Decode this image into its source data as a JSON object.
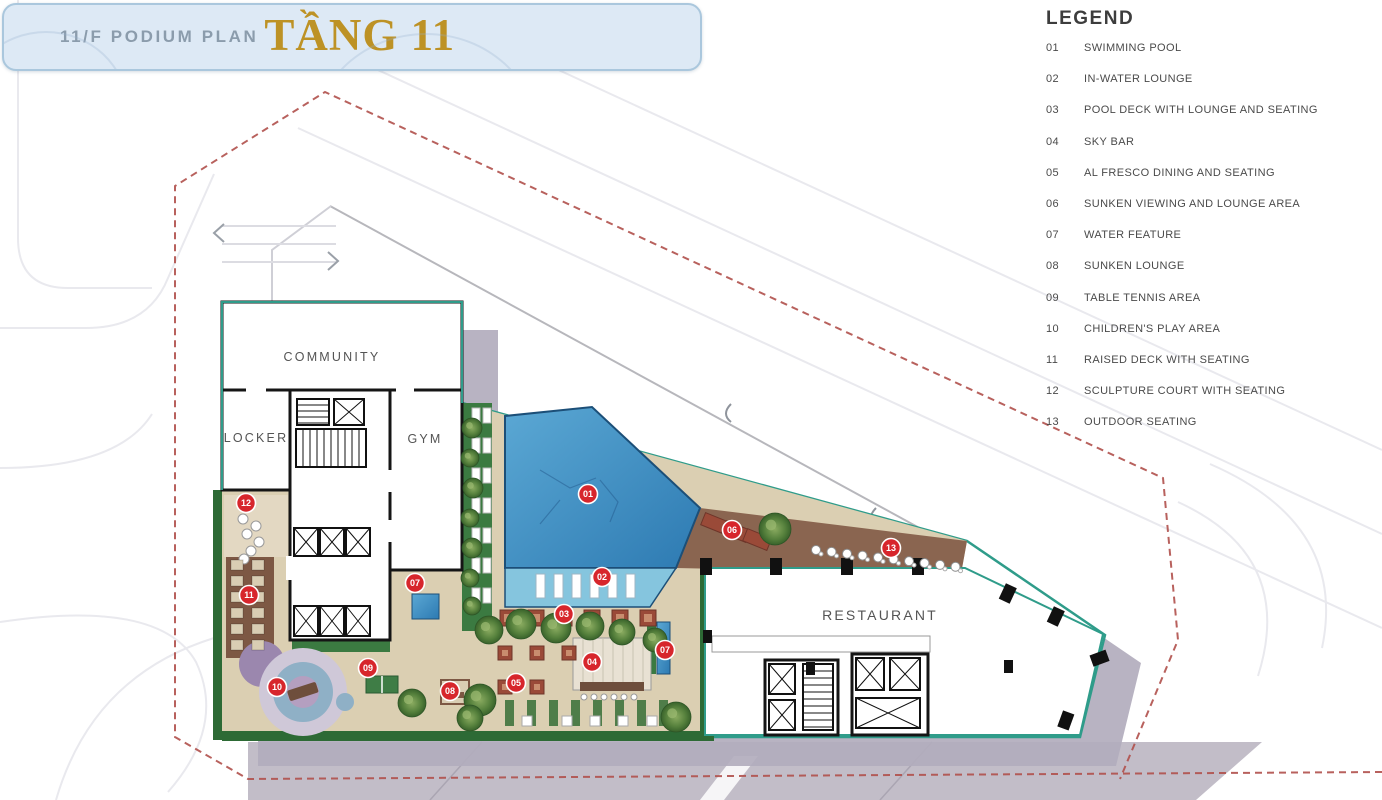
{
  "title": {
    "plan_label": "11/F PODIUM PLAN",
    "floor_label": "TẦNG 11"
  },
  "legend": {
    "heading": "LEGEND",
    "items": [
      {
        "num": "01",
        "label": "SWIMMING POOL"
      },
      {
        "num": "02",
        "label": "IN-WATER LOUNGE"
      },
      {
        "num": "03",
        "label": "POOL DECK WITH LOUNGE AND SEATING"
      },
      {
        "num": "04",
        "label": "SKY BAR"
      },
      {
        "num": "05",
        "label": "AL FRESCO DINING AND SEATING"
      },
      {
        "num": "06",
        "label": "SUNKEN VIEWING AND LOUNGE AREA"
      },
      {
        "num": "07",
        "label": "WATER FEATURE"
      },
      {
        "num": "08",
        "label": "SUNKEN LOUNGE"
      },
      {
        "num": "09",
        "label": "TABLE TENNIS AREA"
      },
      {
        "num": "10",
        "label": "CHILDREN'S PLAY AREA"
      },
      {
        "num": "11",
        "label": "RAISED DECK WITH SEATING"
      },
      {
        "num": "12",
        "label": "SCULPTURE COURT WITH SEATING"
      },
      {
        "num": "13",
        "label": "OUTDOOR SEATING"
      }
    ]
  },
  "plan": {
    "rooms": [
      {
        "id": "community",
        "label": "COMMUNITY",
        "x": 332,
        "y": 361,
        "fs": 12.5
      },
      {
        "id": "locker",
        "label": "LOCKER",
        "x": 256,
        "y": 442,
        "fs": 12.5
      },
      {
        "id": "gym",
        "label": "GYM",
        "x": 425,
        "y": 443,
        "fs": 12.5
      },
      {
        "id": "restaurant",
        "label": "RESTAURANT",
        "x": 880,
        "y": 620,
        "fs": 14
      }
    ],
    "markers": [
      {
        "num": "01",
        "x": 588,
        "y": 494
      },
      {
        "num": "02",
        "x": 602,
        "y": 577
      },
      {
        "num": "03",
        "x": 564,
        "y": 614
      },
      {
        "num": "04",
        "x": 592,
        "y": 662
      },
      {
        "num": "05",
        "x": 516,
        "y": 683
      },
      {
        "num": "06",
        "x": 732,
        "y": 530
      },
      {
        "num": "07",
        "x": 415,
        "y": 583
      },
      {
        "num": "07",
        "x": 665,
        "y": 650
      },
      {
        "num": "08",
        "x": 450,
        "y": 691
      },
      {
        "num": "09",
        "x": 368,
        "y": 668
      },
      {
        "num": "10",
        "x": 277,
        "y": 687
      },
      {
        "num": "11",
        "x": 249,
        "y": 595
      },
      {
        "num": "12",
        "x": 246,
        "y": 503
      },
      {
        "num": "13",
        "x": 891,
        "y": 548
      }
    ],
    "colors": {
      "marker_red": "#d7262c",
      "gold": "#bd9225",
      "banner_bg": "#dde9f5",
      "banner_border": "#aac7dd",
      "boundary_dash": "#b0504b",
      "teal_edge": "#2f9c8a",
      "pool_deep": "#2d7ab2",
      "pool_shallow": "#85c5de",
      "deck_tan": "#dbcfb2",
      "wood_brown": "#8a6550",
      "landscape_green": "#2d6a35",
      "shadow_gray": "#b2acbd",
      "road_gray": "#c2bdc8",
      "legend_text": "#4a4a4a"
    }
  }
}
